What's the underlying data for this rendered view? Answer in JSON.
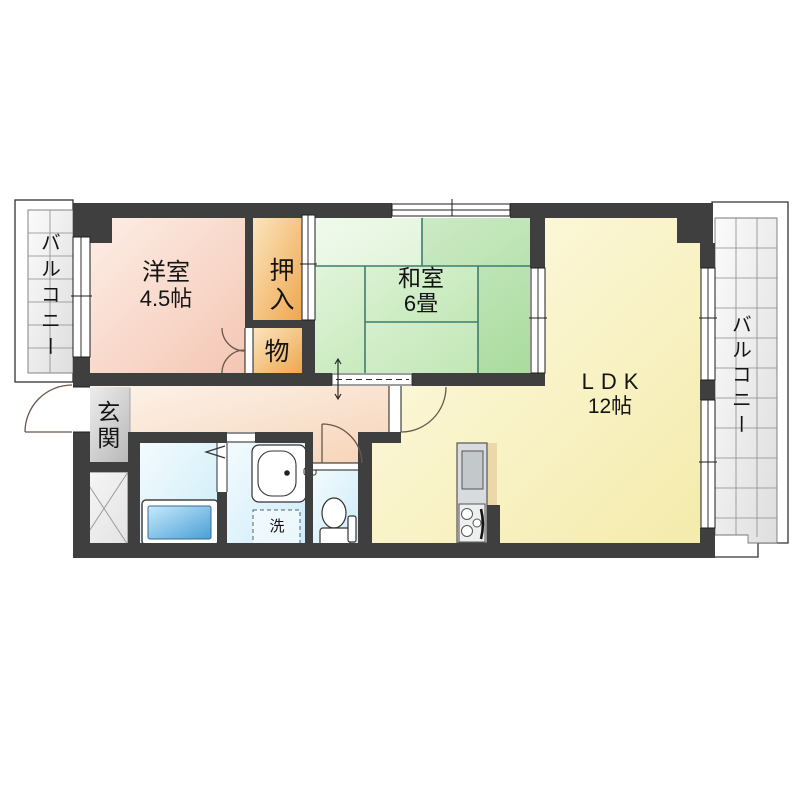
{
  "rooms": {
    "yoshitsu": {
      "name": "洋室",
      "size": "4.5帖"
    },
    "washitsu": {
      "name": "和室",
      "size": "6畳"
    },
    "ldk": {
      "name": "LDK",
      "size": "12帖"
    },
    "oshiire": {
      "name": "押入"
    },
    "mono": {
      "name": "物"
    },
    "genkan": {
      "name": "玄関"
    },
    "laundry": {
      "name": "洗"
    },
    "balcony_left": {
      "name": "バルコニー"
    },
    "balcony_right": {
      "name": "バルコニー"
    }
  },
  "colors": {
    "wall": "#3f3f3f",
    "yoshitsu_fill": "#f6cdbb",
    "washitsu_fill": "#c6ebb8",
    "tatami_line": "#3e7d6e",
    "ldk_fill": "#f7efb8",
    "hallway_fill": "#f8d9c0",
    "closet_fill": "#f0a952",
    "genkan_fill": "#c4c4c4",
    "wetroom_fill": "#d4eef9",
    "bathtub_fill": "#4a9fd6",
    "kitchen_counter": "#d9dcde",
    "balcony_fill": "#e7e7e7"
  }
}
